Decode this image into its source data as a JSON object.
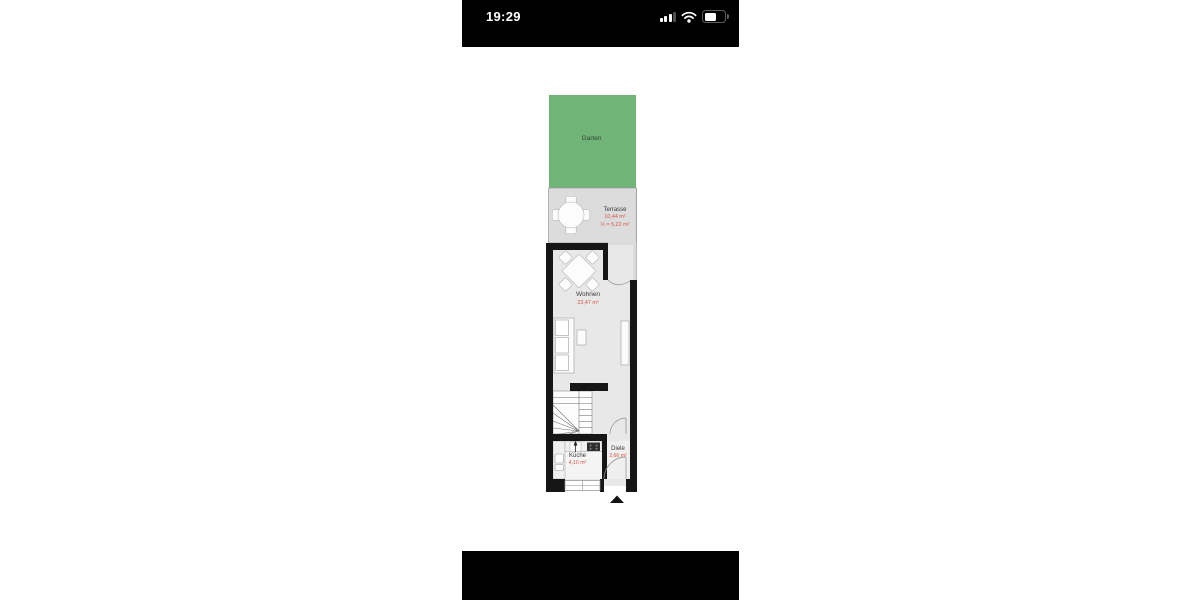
{
  "status_bar": {
    "time": "19:29",
    "cellular_bars_total": 4,
    "cellular_bars_active": 3,
    "wifi": "connected",
    "battery_level_percent": 55
  },
  "floorplan": {
    "rooms": {
      "garden": {
        "label": "Garten"
      },
      "terrace": {
        "label": "Terrasse",
        "area": "10,44 m²",
        "half_area": "½ = 5,22 m²"
      },
      "living_room": {
        "label": "Wohnen",
        "area": "23,47 m²"
      },
      "kitchen": {
        "label": "Küche",
        "area": "4,10 m²"
      },
      "hallway": {
        "label": "Diele",
        "area": "2,66 m²"
      }
    },
    "icons": [
      "terrace-dining-set",
      "living-dining-set",
      "sofa",
      "side-table",
      "sideboard",
      "stairs",
      "kitchen-counter",
      "sink",
      "stove",
      "walk-direction-arrow",
      "entrance-marker-triangle",
      "door-swing-arcs",
      "window"
    ],
    "colors": {
      "garden_green": "#70b577",
      "terrace_floor": "#dcdcdc",
      "room_floor": "#e8e8e8",
      "wall": "#161616",
      "area_value_red": "#d8554b",
      "room_label": "#3a3a3a"
    }
  }
}
